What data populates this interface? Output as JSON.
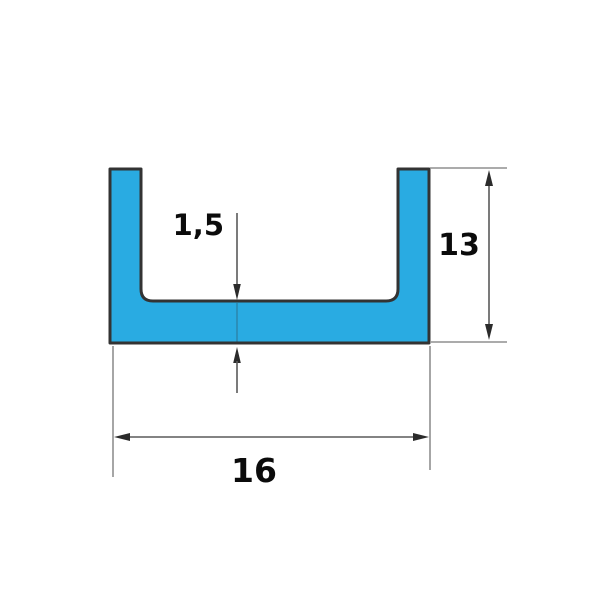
{
  "figure": {
    "type": "technical-drawing",
    "subject": "u-channel-profile-cross-section",
    "dimensions": {
      "wall_thickness": {
        "label": "1,5"
      },
      "height": {
        "label": "13"
      },
      "width": {
        "label": "16"
      }
    },
    "colors": {
      "background": "#ffffff",
      "profile_fill": "#29abe2",
      "profile_outline": "#333333",
      "dimension_line": "#5a5a5a",
      "extension_line": "#8f8f8f",
      "arrowhead": "#2b2b2b",
      "label_text": "#0b0b0b"
    }
  }
}
